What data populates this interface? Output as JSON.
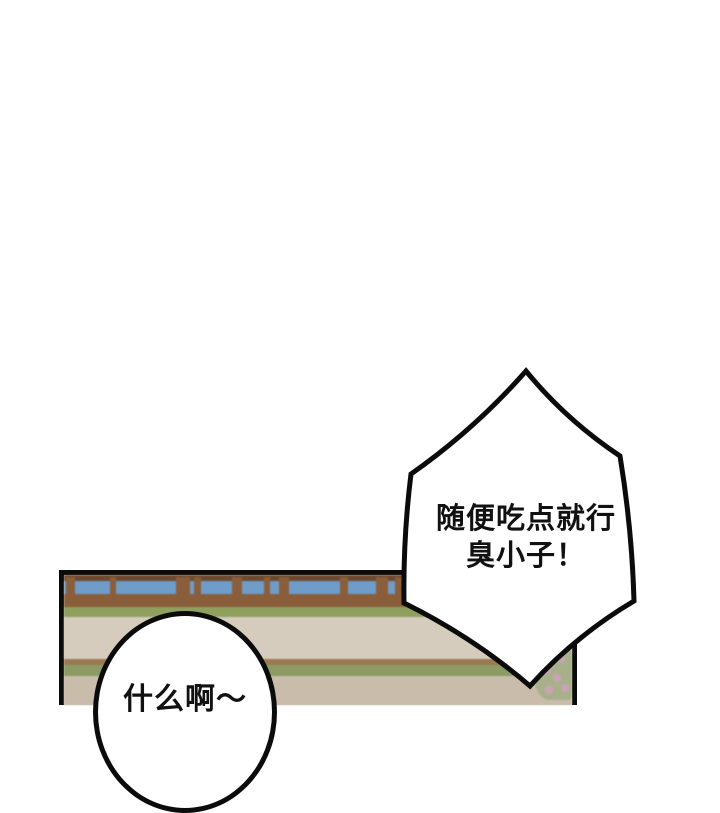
{
  "bubbles": {
    "shout": {
      "line1": "随便吃点就行",
      "line2": "臭小子！"
    },
    "reply": {
      "text": "什么啊～"
    }
  },
  "colors": {
    "outline": "#0b0b0b",
    "bubble_fill": "#ffffff",
    "sky": "#6f9cc8",
    "fence_top_rail": "#6d4a2f",
    "fence_wood": "#8a5e3a",
    "grass": "#8e9f5e",
    "path": "#d6ccbe",
    "garden_strip_brown": "#9b7a52",
    "garden_strip_green": "#8c9a64",
    "floor": "#c9bcab",
    "bush_green": "#a8b08b",
    "flower_pink": "#cba3b6"
  }
}
